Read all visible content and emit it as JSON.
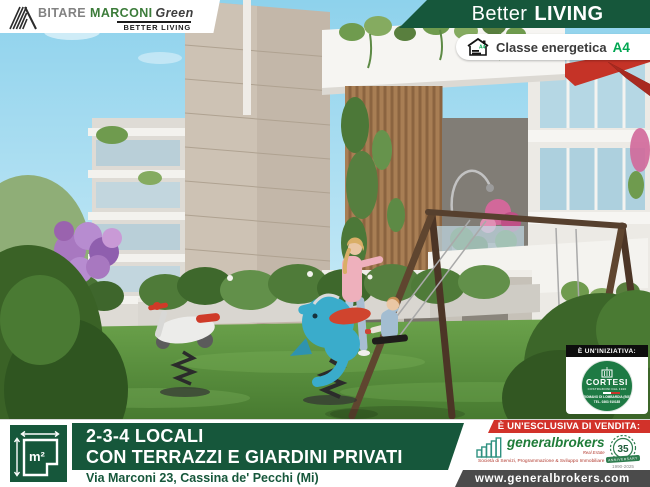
{
  "brand": {
    "part1": "BITARE",
    "part2": "MARCONI",
    "part3": "Green",
    "tagline": "BETTER LIVING"
  },
  "ribbon": {
    "word1": "Better",
    "word2": "LIVING"
  },
  "energy": {
    "label": "Classe energetica",
    "class": "A4",
    "icon_class": "A4"
  },
  "initiative": {
    "label": "È UN'INIZIATIVA:",
    "company": "CORTESI",
    "subtitle": "COSTRUZIONI DAL 1920",
    "address": "ROMANO DI LOMBARDIA (BG)",
    "phone": "TEL. 0363 910185"
  },
  "offer": {
    "line1": "2-3-4 LOCALI",
    "line2": "CON TERRAZZI E GIARDINI PRIVATI",
    "street": "Via Marconi 23, Cassina de' Pecchi (Mi)",
    "area_symbol": "m²"
  },
  "agency": {
    "label": "È UN'ESCLUSIVA DI VENDITA:",
    "name": "generalbrokers",
    "sub": "Real Estate",
    "tagline": "Società di Servizi, Programmazione & Sviluppo Immobiliare",
    "anniversary": {
      "number": "35",
      "word": "ANNIVERSARY",
      "years": "1990-2025"
    },
    "website": "www.generalbrokers.com"
  },
  "colors": {
    "green-dark": "#16573b",
    "logo-green": "#3c7c3a",
    "red": "#d2322a",
    "a4-green": "#00a651",
    "agency-green": "#1f7c39",
    "cortesi-green": "#1e7a44",
    "www-gray": "#4b4b4b"
  }
}
